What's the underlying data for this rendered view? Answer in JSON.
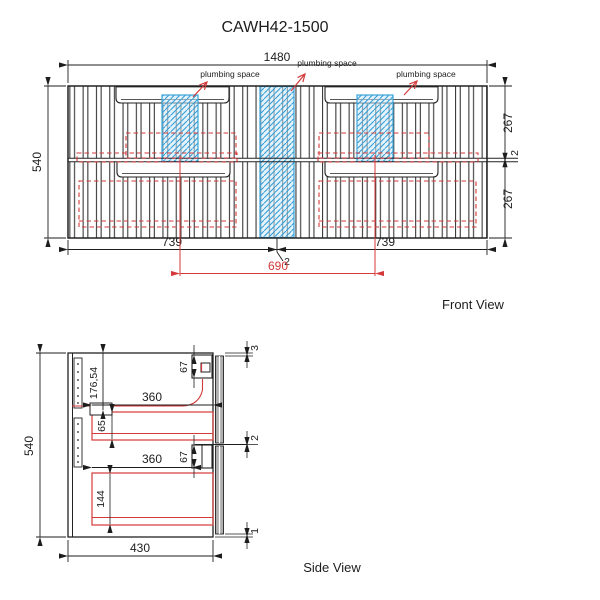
{
  "title": "CAWH42-1500",
  "colors": {
    "line": "#2a2a2a",
    "red_accent": "#d43a3a",
    "plumbing_fill": "#cde9f7",
    "plumbing_hatch": "#2e9bd6",
    "panel_grey": "#b0b0b0"
  },
  "front": {
    "caption": "Front View",
    "labels": {
      "plumbing_left": "plumbing space",
      "plumbing_center": "plumbing space",
      "plumbing_right": "plumbing space"
    },
    "dims": {
      "total_width": "1480",
      "total_height": "540",
      "top_drawer_height": "267",
      "mid_gap": "2",
      "bottom_drawer_height": "267",
      "left_drawer_width": "739",
      "right_drawer_width": "739",
      "center_gap": "2",
      "plumbing_centers": "690"
    }
  },
  "side": {
    "caption": "Side View",
    "dims": {
      "total_height": "540",
      "total_depth": "430",
      "top_to_drawer": "176,54",
      "upper_drawer_depth": "360",
      "upper_box_height": "65",
      "upper_handle_height": "67",
      "lower_drawer_depth": "360",
      "lower_handle_height": "67",
      "lower_box_height": "144",
      "top_gap": "3",
      "mid_gap": "2",
      "bottom_gap": "1"
    }
  }
}
